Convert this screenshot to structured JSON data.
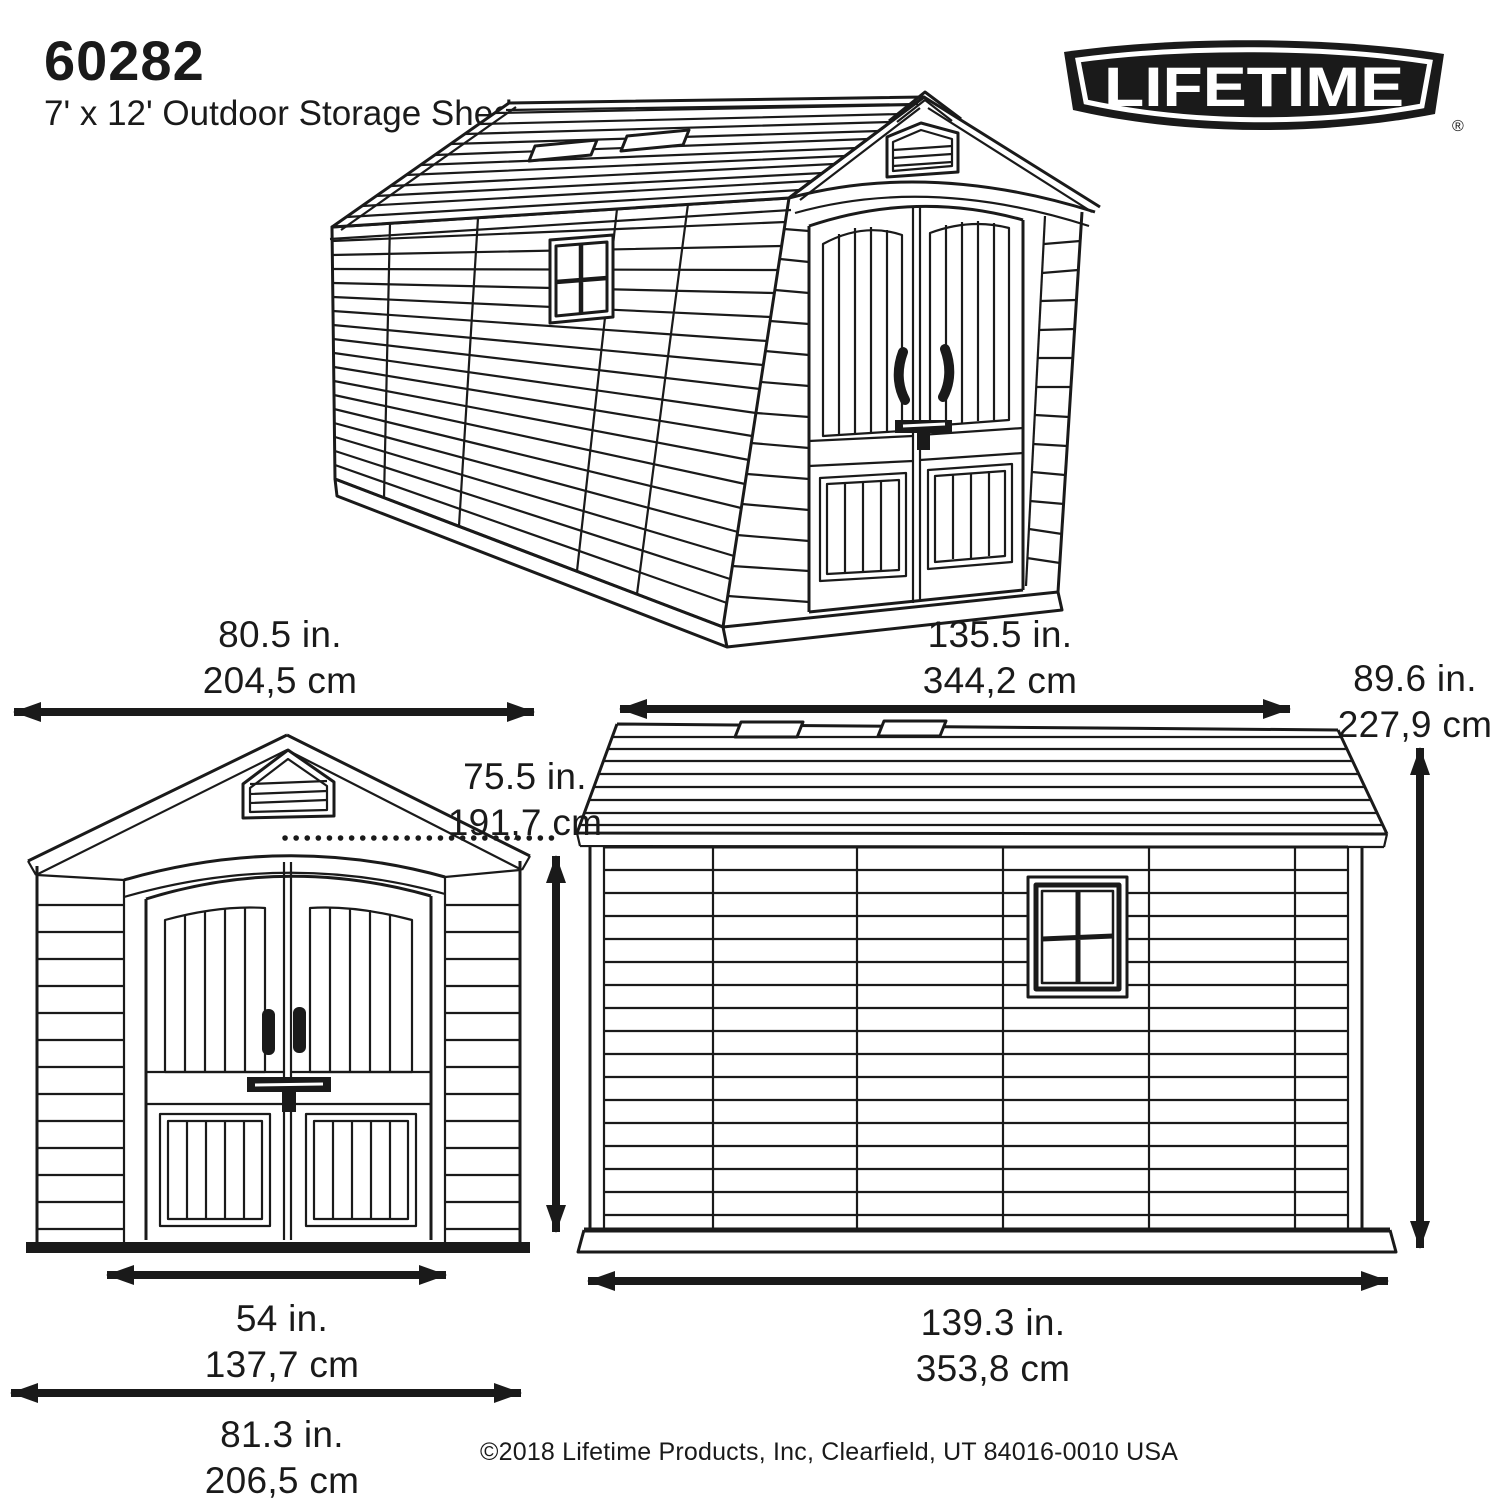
{
  "header": {
    "model": "60282",
    "subtitle": "7' x 12' Outdoor Storage Shed"
  },
  "logo": {
    "brand": "LIFETIME",
    "registered": "®"
  },
  "dimensions": {
    "front_roof_width": {
      "in": "80.5 in.",
      "cm": "204,5 cm"
    },
    "length_overall": {
      "in": "135.5 in.",
      "cm": "344,2 cm"
    },
    "height_peak": {
      "in": "89.6 in.",
      "cm": "227,9 cm"
    },
    "height_eave": {
      "in": "75.5 in.",
      "cm": "191,7 cm"
    },
    "door_opening_width": {
      "in": "54 in.",
      "cm": "137,7 cm"
    },
    "front_base_width": {
      "in": "81.3 in.",
      "cm": "206,5 cm"
    },
    "side_base_length": {
      "in": "139.3 in.",
      "cm": "353,8 cm"
    }
  },
  "footer": {
    "copyright": "©2018 Lifetime Products, Inc, Clearfield, UT 84016-0010 USA"
  }
}
